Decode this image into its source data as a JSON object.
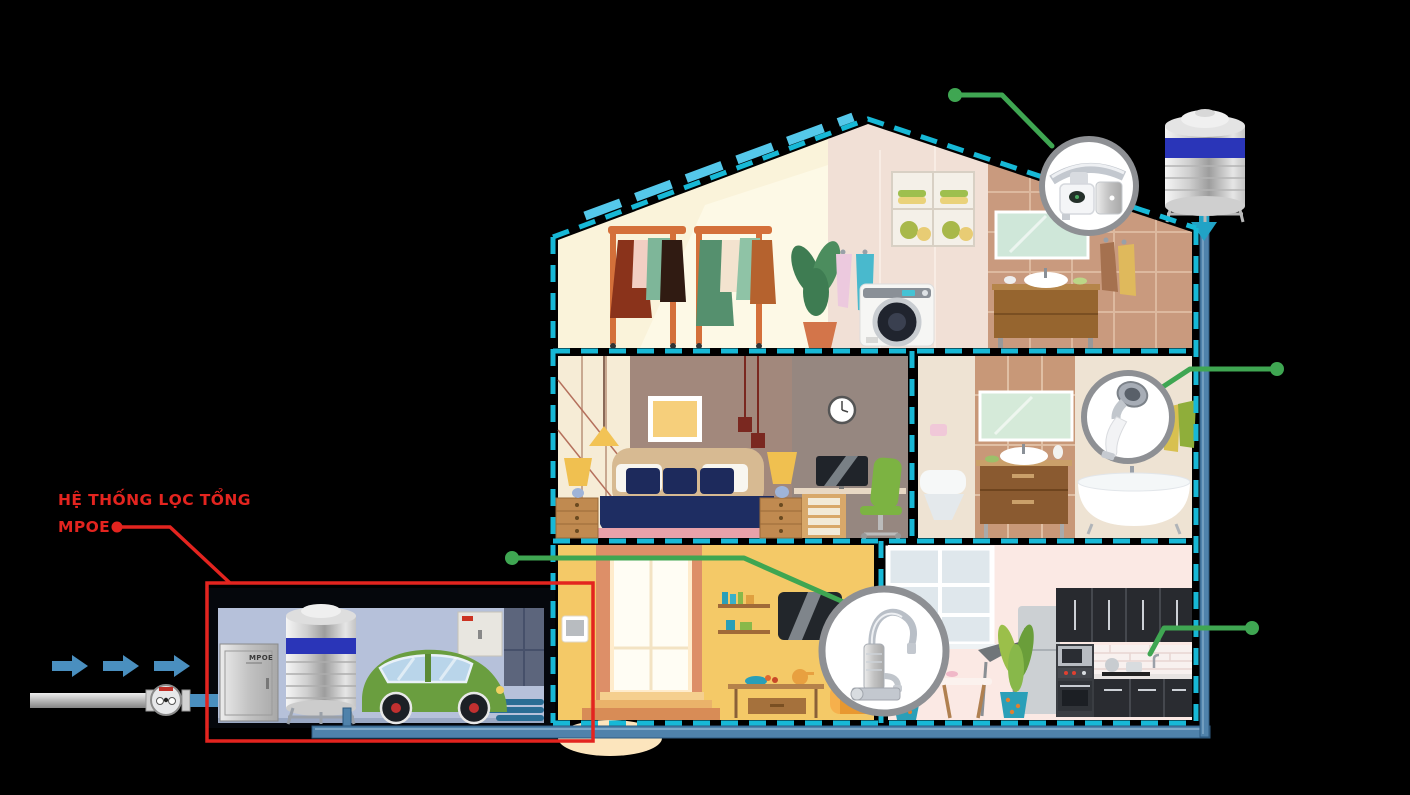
{
  "annotation": {
    "line1": "HỆ THỐNG LỌC TỔNG",
    "line2": "MPOE"
  },
  "garage": {
    "cabinet_label": "MPOE"
  },
  "icons": {
    "callout_top": "tap-filter-inset",
    "callout_middle": "shower-filter-inset",
    "callout_living": "ro-faucet-inset",
    "callout_kitchen": "kitchen-faucet-pointer",
    "flow": "water-inlet-arrows",
    "tank": "rooftop-water-tank",
    "meter": "water-meter"
  },
  "colors": {
    "background": "#000000",
    "outline_teal": "#17b8d6",
    "roof_accent": "#55c8ea",
    "callout_green": "#3fa652",
    "annotation_red": "#e3241f",
    "pipe_blue": "#4f82ab",
    "arrow_blue": "#4a8fbf",
    "tank_band_blue": "#2a35b8"
  }
}
